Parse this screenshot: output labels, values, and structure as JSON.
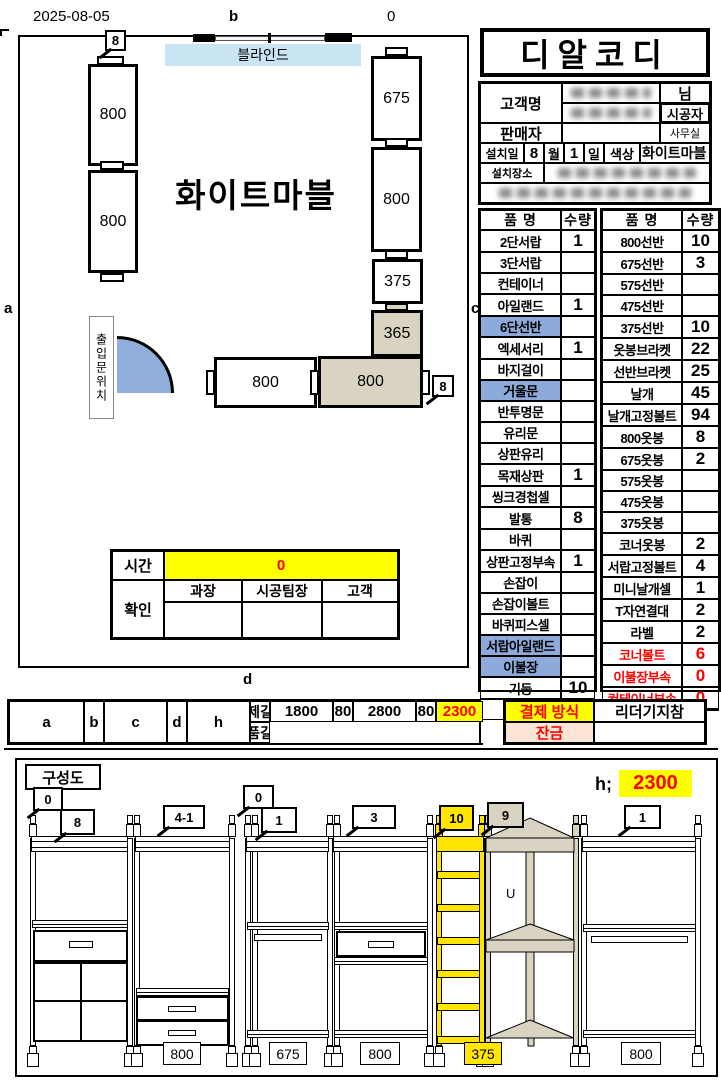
{
  "meta": {
    "date": "2025-08-05",
    "b": "b",
    "zero": "0",
    "a": "a",
    "c": "c",
    "d": "d"
  },
  "plan": {
    "blinds": "블라인드",
    "finish": "화이트마블",
    "door": "출입문위치",
    "callout_top": "8",
    "callout_right": "8",
    "boxes": {
      "l800a": "800",
      "l800b": "800",
      "r675": "675",
      "r800": "800",
      "r375": "375",
      "r365": "365",
      "f800w": "800",
      "f800t": "800"
    },
    "time": {
      "label": "시간",
      "value": "0",
      "confirm": "확인",
      "cols": [
        "과장",
        "시공팀장",
        "고객"
      ]
    }
  },
  "brand": {
    "title": "디알코디"
  },
  "info": {
    "customer_label": "고객명",
    "honorific": "님",
    "installer_label": "시공자",
    "seller_label": "판매자",
    "office_label": "사무실",
    "install_date_label": "설치일",
    "month_value": "8",
    "month_label": "월",
    "day_value": "1",
    "day_label": "일",
    "color_label": "색상",
    "color_value": "화이트마블",
    "location_label": "설치장소"
  },
  "parts_left": {
    "h_name": "품 명",
    "h_qty": "수량",
    "total": "합 계",
    "rows": [
      {
        "name": "2단서랍",
        "qty": "1"
      },
      {
        "name": "3단서랍",
        "qty": ""
      },
      {
        "name": "컨테이너",
        "qty": ""
      },
      {
        "name": "아일랜드",
        "qty": "1"
      },
      {
        "name": "6단선반",
        "qty": "",
        "hl": true
      },
      {
        "name": "엑세서리",
        "qty": "1"
      },
      {
        "name": "바지걸이",
        "qty": ""
      },
      {
        "name": "거울문",
        "qty": "",
        "hl": true
      },
      {
        "name": "반투명문",
        "qty": ""
      },
      {
        "name": "유리문",
        "qty": ""
      },
      {
        "name": "상판유리",
        "qty": ""
      },
      {
        "name": "목재상판",
        "qty": "1"
      },
      {
        "name": "씽크경첩셀",
        "qty": ""
      },
      {
        "name": "발통",
        "qty": "8"
      },
      {
        "name": "바퀴",
        "qty": ""
      },
      {
        "name": "상판고정부속",
        "qty": "1"
      },
      {
        "name": "손잡이",
        "qty": ""
      },
      {
        "name": "손잡이볼트",
        "qty": ""
      },
      {
        "name": "바퀴피스셀",
        "qty": ""
      },
      {
        "name": "서랍아일랜드",
        "qty": "",
        "hl": true
      },
      {
        "name": "이불장",
        "qty": "",
        "hl": true
      },
      {
        "name": "기둥",
        "qty": "10"
      }
    ]
  },
  "parts_right": {
    "h_name": "품 명",
    "h_qty": "수량",
    "rows": [
      {
        "name": "800선반",
        "qty": "10"
      },
      {
        "name": "675선반",
        "qty": "3"
      },
      {
        "name": "575선반",
        "qty": ""
      },
      {
        "name": "475선반",
        "qty": ""
      },
      {
        "name": "375선반",
        "qty": "10"
      },
      {
        "name": "옷봉브라켓",
        "qty": "22"
      },
      {
        "name": "선반브라켓",
        "qty": "25"
      },
      {
        "name": "날개",
        "qty": "45"
      },
      {
        "name": "날개고정볼트",
        "qty": "94"
      },
      {
        "name": "800옷봉",
        "qty": "8"
      },
      {
        "name": "675옷봉",
        "qty": "2"
      },
      {
        "name": "575옷봉",
        "qty": ""
      },
      {
        "name": "475옷봉",
        "qty": ""
      },
      {
        "name": "375옷봉",
        "qty": ""
      },
      {
        "name": "코너옷봉",
        "qty": "2"
      },
      {
        "name": "서랍고정볼트",
        "qty": "4"
      },
      {
        "name": "미니날개셀",
        "qty": "1"
      },
      {
        "name": "T자연결대",
        "qty": "2"
      },
      {
        "name": "라벨",
        "qty": "2"
      },
      {
        "name": "코너볼트",
        "qty": "6",
        "red": true
      },
      {
        "name": "이불장부속",
        "qty": "0",
        "red": true
      },
      {
        "name": "컨테이너부속",
        "qty": "0",
        "red": true
      },
      {
        "name": "",
        "qty": ""
      }
    ]
  },
  "measure": {
    "row1": "실제길이",
    "row2": "제품길이",
    "segs": [
      {
        "key": "a",
        "actual": "1800",
        "product": "1675"
      },
      {
        "key": "b",
        "actual": "2800",
        "product": "0"
      },
      {
        "key": "c",
        "actual": "2800",
        "product": "2740"
      },
      {
        "key": "d",
        "actual": "1800",
        "product": "1675"
      },
      {
        "key": "h",
        "actual": "2300",
        "product": "화이트마블"
      }
    ]
  },
  "pay": {
    "method_label": "결제 방식",
    "method_value": "리더기지참",
    "balance_label": "잔금",
    "balance_value": ""
  },
  "elev": {
    "title": "구성도",
    "h_label": "h;",
    "h_value": "2300",
    "hook": "U",
    "callouts": [
      "0",
      "8",
      "4-1",
      "0",
      "1",
      "3",
      "10",
      "9",
      "1"
    ],
    "widths": [
      "800",
      "675",
      "800",
      "375",
      "800"
    ]
  }
}
